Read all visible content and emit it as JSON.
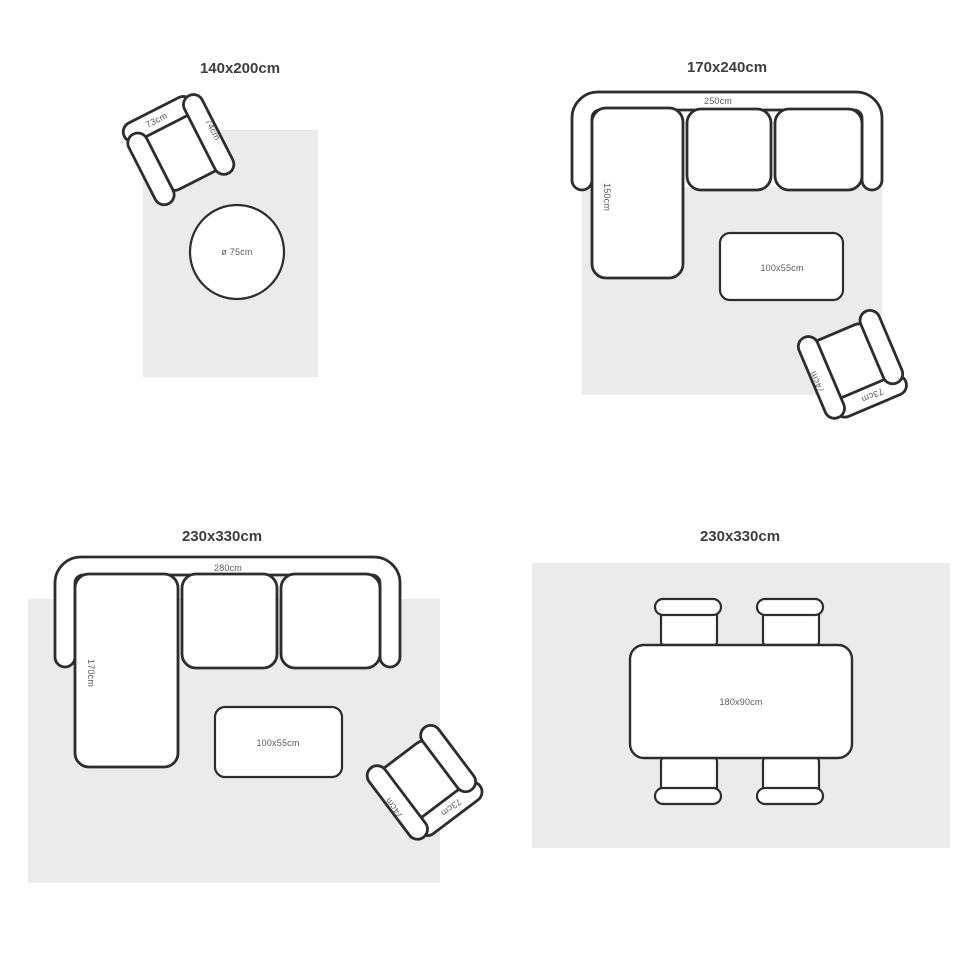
{
  "colors": {
    "rug": "#ebebeb",
    "outline": "#2d2d2d",
    "label": "#5a5a5a",
    "title": "#3d3d3d"
  },
  "panels": {
    "top_left": {
      "title": "140x200cm",
      "chair": {
        "back_label": "73cm",
        "arm_label": "74cm"
      },
      "round_table_label": "ø 75cm"
    },
    "top_right": {
      "title": "170x240cm",
      "sofa": {
        "width_label": "250cm",
        "depth_label": "150cm"
      },
      "coffee_table_label": "100x55cm",
      "chair": {
        "back_label": "73cm",
        "arm_label": "74cm"
      }
    },
    "bottom_left": {
      "title": "230x330cm",
      "sofa": {
        "width_label": "280cm",
        "depth_label": "170cm"
      },
      "coffee_table_label": "100x55cm",
      "chair": {
        "back_label": "73cm",
        "arm_label": "74cm"
      }
    },
    "bottom_right": {
      "title": "230x330cm",
      "dining_table_label": "180x90cm"
    }
  }
}
